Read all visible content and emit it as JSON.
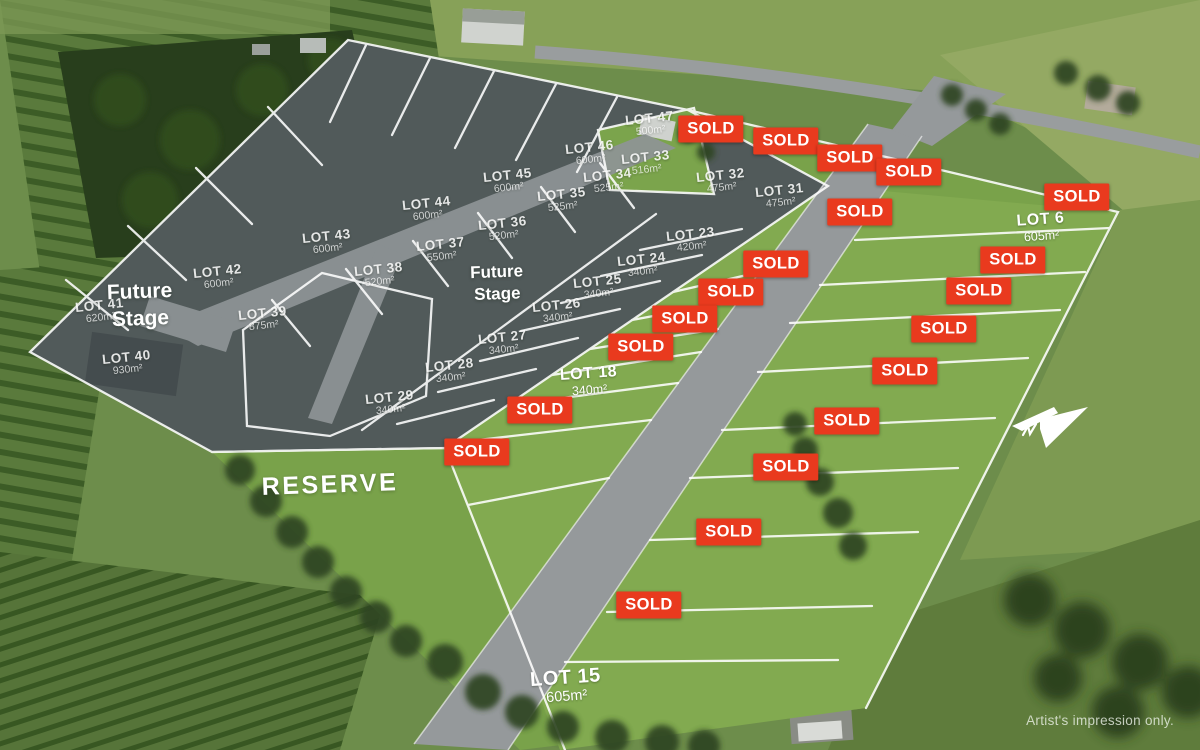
{
  "credit": "Artist's impression only.",
  "reserve": {
    "text": "RESERVE"
  },
  "future_stages": [
    {
      "lines": [
        "Future",
        "Stage"
      ],
      "x": 140,
      "y": 306,
      "size": 21
    },
    {
      "lines": [
        "Future",
        "Stage"
      ],
      "x": 497,
      "y": 283,
      "size": 17
    }
  ],
  "sold": {
    "text": "SOLD",
    "color": "#e93a1e",
    "positions": [
      [
        711,
        129
      ],
      [
        786,
        141
      ],
      [
        850,
        158
      ],
      [
        909,
        172
      ],
      [
        860,
        212
      ],
      [
        1077,
        197
      ],
      [
        1013,
        260
      ],
      [
        979,
        291
      ],
      [
        944,
        329
      ],
      [
        905,
        371
      ],
      [
        847,
        421
      ],
      [
        786,
        467
      ],
      [
        729,
        532
      ],
      [
        649,
        605
      ],
      [
        776,
        264
      ],
      [
        731,
        292
      ],
      [
        685,
        319
      ],
      [
        641,
        347
      ],
      [
        540,
        410
      ],
      [
        477,
        452
      ]
    ]
  },
  "lots": [
    {
      "name": "LOT 47",
      "area": "500m²",
      "x": 650,
      "y": 124,
      "style": "dim"
    },
    {
      "name": "LOT 46",
      "area": "600m²",
      "x": 590,
      "y": 153,
      "style": "dim"
    },
    {
      "name": "LOT 45",
      "area": "600m²",
      "x": 508,
      "y": 181,
      "style": "dim"
    },
    {
      "name": "LOT 44",
      "area": "600m²",
      "x": 427,
      "y": 209,
      "style": "dim"
    },
    {
      "name": "LOT 43",
      "area": "600m²",
      "x": 327,
      "y": 242,
      "style": "dim"
    },
    {
      "name": "LOT 42",
      "area": "600m²",
      "x": 218,
      "y": 277,
      "style": "dim"
    },
    {
      "name": "LOT 41",
      "area": "620m²",
      "x": 100,
      "y": 311,
      "style": "dim"
    },
    {
      "name": "LOT 40",
      "area": "930m²",
      "x": 127,
      "y": 363,
      "style": "dim"
    },
    {
      "name": "LOT 39",
      "area": "875m²",
      "x": 263,
      "y": 319,
      "style": "dim"
    },
    {
      "name": "LOT 38",
      "area": "520m²",
      "x": 379,
      "y": 275,
      "style": "dim"
    },
    {
      "name": "LOT 37",
      "area": "550m²",
      "x": 441,
      "y": 250,
      "style": "dim"
    },
    {
      "name": "LOT 36",
      "area": "520m²",
      "x": 503,
      "y": 229,
      "style": "dim"
    },
    {
      "name": "LOT 35",
      "area": "525m²",
      "x": 562,
      "y": 200,
      "style": "dim"
    },
    {
      "name": "LOT 34",
      "area": "525m²",
      "x": 608,
      "y": 181,
      "style": "dim"
    },
    {
      "name": "LOT 33",
      "area": "516m²",
      "x": 646,
      "y": 163,
      "style": "dim"
    },
    {
      "name": "LOT 32",
      "area": "475m²",
      "x": 721,
      "y": 181,
      "style": "dim"
    },
    {
      "name": "LOT 31",
      "area": "475m²",
      "x": 780,
      "y": 196,
      "style": "dim"
    },
    {
      "name": "LOT 23",
      "area": "420m²",
      "x": 691,
      "y": 240,
      "style": "dim"
    },
    {
      "name": "LOT 24",
      "area": "340m²",
      "x": 642,
      "y": 265,
      "style": "dim"
    },
    {
      "name": "LOT 25",
      "area": "340m²",
      "x": 598,
      "y": 287,
      "style": "dim"
    },
    {
      "name": "LOT 26",
      "area": "340m²",
      "x": 557,
      "y": 311,
      "style": "dim"
    },
    {
      "name": "LOT 27",
      "area": "340m²",
      "x": 503,
      "y": 343,
      "style": "dim"
    },
    {
      "name": "LOT 28",
      "area": "340m²",
      "x": 450,
      "y": 371,
      "style": "dim"
    },
    {
      "name": "LOT 29",
      "area": "340m²",
      "x": 390,
      "y": 403,
      "style": "dim"
    },
    {
      "name": "LOT 18",
      "area": "340m²",
      "x": 589,
      "y": 381,
      "style": "bold"
    },
    {
      "name": "LOT 6",
      "area": "605m²",
      "x": 1041,
      "y": 227,
      "style": "bold"
    },
    {
      "name": "LOT 15",
      "area": "605m²",
      "x": 566,
      "y": 686,
      "style": "bold xl"
    }
  ]
}
